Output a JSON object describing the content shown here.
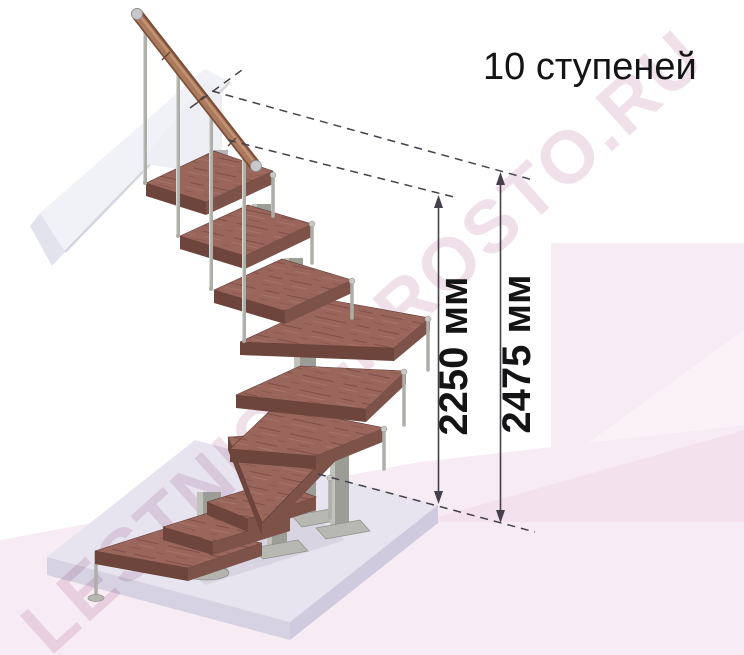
{
  "illustration": {
    "title": "10 ступеней",
    "steps_count": 10,
    "watermark": "LESTNICA-PROSTO.RU",
    "dimensions": [
      {
        "name": "height-to-top-step",
        "value": "2250 мм"
      },
      {
        "name": "overall-height",
        "value": "2475 мм"
      }
    ]
  },
  "colors": {
    "wood": "#9a665c",
    "woodDark": "#6d453d",
    "woodMid": "#7d5248",
    "metal": "#aeaea8",
    "metalDark": "#9d9d97",
    "pink": "#f8ecf4",
    "pinkDark": "#f3e1ee",
    "pinkLight": "#fbf2f8",
    "floor": "#e7e4ef",
    "panel": "#f1f2f7",
    "line": "#45404b",
    "ink": "#141414",
    "watermark": "#eddbe7",
    "rail": "#a97a5d"
  }
}
